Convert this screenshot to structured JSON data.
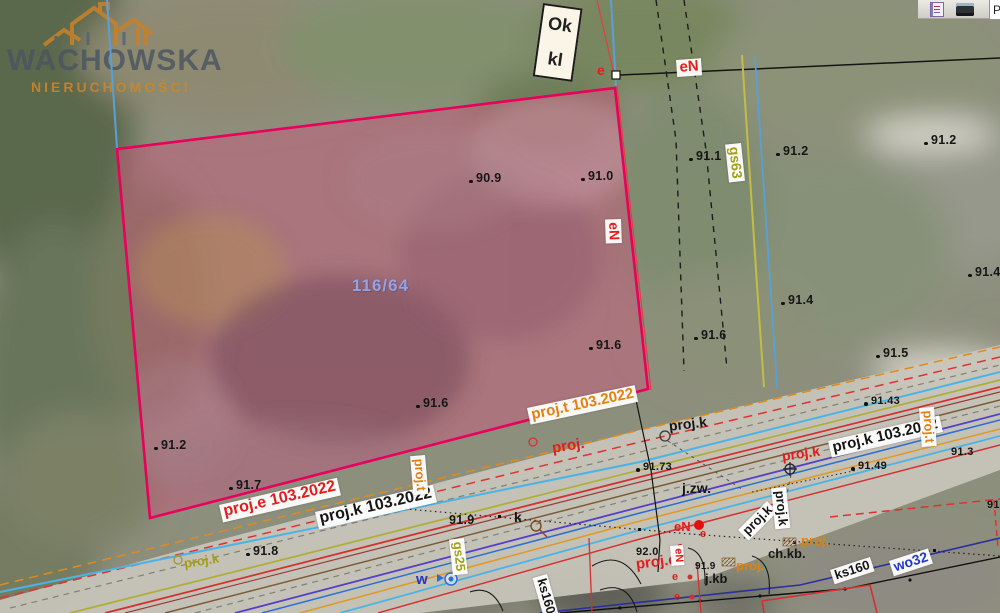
{
  "watermark": {
    "brand": "WACHOWSKA",
    "subtitle": "NIERUCHOMOŚCI"
  },
  "ok_box": {
    "line1": "Ok",
    "line2": "kl"
  },
  "toolbar": {
    "button_label": "P"
  },
  "colors": {
    "parcel_outline": "#e8005c",
    "parcel_fill": "rgba(207,84,122,0.44)",
    "brand_orange": "#cd8629",
    "brand_gray": "#4a5562",
    "utility_red": "#d43030",
    "utility_blue": "#2b6fd4",
    "utility_cyan": "#4ab4e6",
    "utility_yellow": "#c2bd45",
    "utility_olive": "#b0ae3a",
    "utility_orange": "#e09a22",
    "utility_navy": "#2a2f9e"
  },
  "labels": [
    {
      "n": "e-top",
      "t": "e",
      "x": 597,
      "y": 63,
      "r": 0,
      "c": "red s14"
    },
    {
      "n": "eN-top",
      "t": "eN",
      "x": 676,
      "y": 60,
      "r": -4,
      "c": "bx red s15"
    },
    {
      "n": "eN-right-vertical",
      "t": "eN",
      "x": 621,
      "y": 219,
      "r": 88,
      "c": "bx red s14"
    },
    {
      "n": "gs63-line",
      "t": "gs63",
      "x": 741,
      "y": 143,
      "r": 84,
      "c": "bx olive s14"
    },
    {
      "n": "elev-91-1",
      "t": "91.1",
      "x": 696,
      "y": 150,
      "r": 0,
      "c": "elev dot"
    },
    {
      "n": "elev-91-2-a",
      "t": "91.2",
      "x": 783,
      "y": 145,
      "r": 0,
      "c": "elev dot"
    },
    {
      "n": "elev-91-2-b",
      "t": "91.2",
      "x": 931,
      "y": 134,
      "r": 0,
      "c": "elev dot"
    },
    {
      "n": "elev-90-9",
      "t": "90.9",
      "x": 476,
      "y": 172,
      "r": 0,
      "c": "elev dot"
    },
    {
      "n": "elev-91-0",
      "t": "91.0",
      "x": 588,
      "y": 170,
      "r": 0,
      "c": "elev dot"
    },
    {
      "n": "parcel-number",
      "t": "116/64",
      "x": 352,
      "y": 277,
      "r": 0,
      "c": "pid"
    },
    {
      "n": "elev-91-4-a",
      "t": "91.4",
      "x": 788,
      "y": 294,
      "r": 0,
      "c": "elev dot"
    },
    {
      "n": "elev-91-6-a",
      "t": "91.6",
      "x": 596,
      "y": 339,
      "r": 0,
      "c": "elev dot"
    },
    {
      "n": "elev-91-6-b",
      "t": "91.6",
      "x": 701,
      "y": 329,
      "r": 0,
      "c": "elev dot"
    },
    {
      "n": "elev-91-5",
      "t": "91.5",
      "x": 883,
      "y": 347,
      "r": 0,
      "c": "elev dot"
    },
    {
      "n": "elev-91-4-edge",
      "t": "91.4",
      "x": 975,
      "y": 266,
      "r": 0,
      "c": "elev dot"
    },
    {
      "n": "elev-91-2-c",
      "t": "91.2",
      "x": 161,
      "y": 439,
      "r": 0,
      "c": "elev dot"
    },
    {
      "n": "elev-91-6-c",
      "t": "91.6",
      "x": 423,
      "y": 397,
      "r": 0,
      "c": "elev dot"
    },
    {
      "n": "elev-91-7",
      "t": "91.7",
      "x": 236,
      "y": 479,
      "r": 0,
      "c": "elev dot"
    },
    {
      "n": "proj-t-103",
      "t": "proj.t 103.2022",
      "x": 527,
      "y": 408,
      "r": -12,
      "c": "bx orange s15"
    },
    {
      "n": "proj-label-mid",
      "t": "proj.",
      "x": 551,
      "y": 441,
      "r": -9,
      "c": "red s15"
    },
    {
      "n": "proj-k-mid",
      "t": "proj.k",
      "x": 668,
      "y": 419,
      "r": -7,
      "c": "blk s14"
    },
    {
      "n": "proj-k-103-right",
      "t": "proj.k 103.2022",
      "x": 828,
      "y": 441,
      "r": -13,
      "c": "bx blk s15"
    },
    {
      "n": "elev-91-43",
      "t": "91.43",
      "x": 871,
      "y": 396,
      "r": 0,
      "c": "elev sm dot"
    },
    {
      "n": "proj-t-vertical-right",
      "t": "proj.t",
      "x": 934,
      "y": 407,
      "r": 86,
      "c": "bx orange s13"
    },
    {
      "n": "elev-91-3",
      "t": "91.3",
      "x": 951,
      "y": 447,
      "r": 0,
      "c": "elev sm"
    },
    {
      "n": "elev-91-49",
      "t": "91.49",
      "x": 858,
      "y": 461,
      "r": 0,
      "c": "elev sm dot"
    },
    {
      "n": "proj-k-red",
      "t": "proj.k",
      "x": 781,
      "y": 449,
      "r": -8,
      "c": "red s14"
    },
    {
      "n": "elev-91-73",
      "t": "91.73",
      "x": 643,
      "y": 462,
      "r": 0,
      "c": "elev sm dot"
    },
    {
      "n": "j-zw",
      "t": "j.zw.",
      "x": 682,
      "y": 481,
      "r": 0,
      "c": "blk s14"
    },
    {
      "n": "proj-e-103",
      "t": "proj.e 103.2022",
      "x": 219,
      "y": 505,
      "r": -13,
      "c": "bx red s16"
    },
    {
      "n": "proj-k-103-left",
      "t": "proj.k 103.2022",
      "x": 315,
      "y": 512,
      "r": -13,
      "c": "bx blk s16"
    },
    {
      "n": "proj-t-vertical-left",
      "t": "proj.t",
      "x": 425,
      "y": 455,
      "r": 85,
      "c": "bx orange s13"
    },
    {
      "n": "proj-k-olive",
      "t": "proj.k",
      "x": 183,
      "y": 557,
      "r": -9,
      "c": "olive s13"
    },
    {
      "n": "elev-91-8",
      "t": "91.8",
      "x": 253,
      "y": 545,
      "r": 0,
      "c": "elev dot"
    },
    {
      "n": "elev-91-9-a",
      "t": "91.9",
      "x": 449,
      "y": 514,
      "r": 0,
      "c": "elev"
    },
    {
      "n": "gs25-line",
      "t": "gs25",
      "x": 464,
      "y": 538,
      "r": 84,
      "c": "bx olive s13"
    },
    {
      "n": "k-point",
      "t": "k",
      "x": 514,
      "y": 510,
      "r": 0,
      "c": "blk s14"
    },
    {
      "n": "w-point",
      "t": "w",
      "x": 416,
      "y": 572,
      "r": 0,
      "c": "blue s15"
    },
    {
      "n": "ks160-vertical",
      "t": "ks160",
      "x": 547,
      "y": 574,
      "r": 74,
      "c": "bx blk s13"
    },
    {
      "n": "elev-92-0",
      "t": "92.0",
      "x": 636,
      "y": 547,
      "r": 0,
      "c": "elev sm"
    },
    {
      "n": "proj-e-bottom",
      "t": "proj.e",
      "x": 635,
      "y": 557,
      "r": -7,
      "c": "red s15"
    },
    {
      "n": "eN-bottom",
      "t": "eN",
      "x": 674,
      "y": 520,
      "r": 0,
      "c": "red s13"
    },
    {
      "n": "e-b1",
      "t": "e",
      "x": 700,
      "y": 529,
      "r": 0,
      "c": "red s11"
    },
    {
      "n": "e-b2",
      "t": "e",
      "x": 677,
      "y": 542,
      "r": 0,
      "c": "red s11"
    },
    {
      "n": "eN-bottom-vertical",
      "t": "eN",
      "x": 683,
      "y": 545,
      "r": 86,
      "c": "bx red s11"
    },
    {
      "n": "e-b3",
      "t": "e",
      "x": 672,
      "y": 572,
      "r": 0,
      "c": "red s11"
    },
    {
      "n": "e-b4",
      "t": "e",
      "x": 674,
      "y": 592,
      "r": 0,
      "c": "red s11"
    },
    {
      "n": "elev-91-9-b",
      "t": "91.9",
      "x": 695,
      "y": 562,
      "r": 0,
      "c": "elev xs"
    },
    {
      "n": "j-kb",
      "t": "j.kb",
      "x": 705,
      "y": 572,
      "r": 0,
      "c": "blk s13"
    },
    {
      "n": "proj-o1",
      "t": "proj.",
      "x": 736,
      "y": 559,
      "r": 0,
      "c": "orange s13"
    },
    {
      "n": "ch-kb",
      "t": "ch.kb.",
      "x": 768,
      "y": 547,
      "r": 0,
      "c": "blk s13"
    },
    {
      "n": "proj-o2",
      "t": "proj.",
      "x": 801,
      "y": 534,
      "r": 0,
      "c": "orange s13"
    },
    {
      "n": "proj-k-diag",
      "t": "proj.k",
      "x": 738,
      "y": 530,
      "r": -45,
      "c": "bx blk s13"
    },
    {
      "n": "proj-k-vert",
      "t": "proj.k",
      "x": 786,
      "y": 487,
      "r": 84,
      "c": "bx blk s13"
    },
    {
      "n": "ks160-bottom",
      "t": "ks160",
      "x": 830,
      "y": 570,
      "r": -18,
      "c": "bx blk s13"
    },
    {
      "n": "wo32",
      "t": "wo32",
      "x": 889,
      "y": 561,
      "r": -18,
      "c": "bx blue s14"
    },
    {
      "n": "elev-edge-91",
      "t": "91",
      "x": 987,
      "y": 500,
      "r": 0,
      "c": "elev sm"
    }
  ]
}
